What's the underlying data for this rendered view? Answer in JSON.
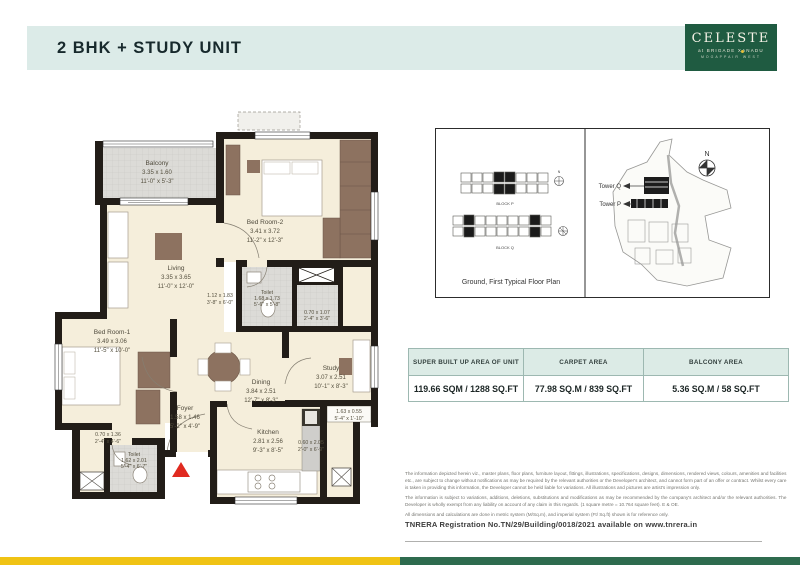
{
  "header": {
    "title": "2 BHK + STUDY UNIT"
  },
  "logo": {
    "name": "CELESTE",
    "subtitle": "at BRIGADE XANADU",
    "location": "MOGAPPAIR WEST"
  },
  "floorplan": {
    "entrance_marker_color": "#e02a20",
    "rooms": {
      "balcony": {
        "name": "Balcony",
        "m": "3.35 x 1.60",
        "i": "11'-0\" x 5'-3\""
      },
      "living": {
        "name": "Living",
        "m": "3.35 x 3.65",
        "i": "11'-0\" x 12'-0\""
      },
      "bed2": {
        "name": "Bed Room-2",
        "m": "3.41 x 3.72",
        "i": "11'-2\" x 12'-3\""
      },
      "passage": {
        "m": "1.12 x 1.83",
        "i": "3'-8\" x 6'-0\""
      },
      "toilet2": {
        "name": "Toilet",
        "m": "1.68 x 1.73",
        "i": "5'-6\" x 5'-8\""
      },
      "shaft": {
        "m": "0.70 x 1.07",
        "i": "2'-4\" x 3'-6\""
      },
      "bed1": {
        "name": "Bed Room-1",
        "m": "3.49 x 3.06",
        "i": "11'-5\" x 10'-0\""
      },
      "niche": {
        "m": "0.70 x 1.36",
        "i": "2'-4\" x 4'-6\""
      },
      "toilet1": {
        "name": "Toilet",
        "m": "1.62 x 2.01",
        "i": "5'-4\" x 6'-7\""
      },
      "foyer": {
        "name": "Foyer",
        "m": "1.58 x 1.46",
        "i": "5'-2\" x 4'-9\""
      },
      "dining": {
        "name": "Dining",
        "m": "3.84 x 2.51",
        "i": "12'-7\" x 8'-3\""
      },
      "study": {
        "name": "Study",
        "m": "3.07 x 2.51",
        "i": "10'-1\" x 8'-3\""
      },
      "kitchen": {
        "name": "Kitchen",
        "m": "2.81 x 2.56",
        "i": "9'-3\" x 8'-5\""
      },
      "utility": {
        "m": "0.60 x 2.05",
        "i": "2'-0\" x 6'-9\""
      },
      "ledge": {
        "m": "1.63 x 0.55",
        "i": "5'-4\" x 1'-10\""
      }
    }
  },
  "keyplan": {
    "caption": "Ground, First Typical Floor Plan",
    "block_p": "BLOCK P",
    "block_q": "BLOCK Q",
    "tower_q": "Tower Q",
    "tower_p": "Tower P",
    "north": "N"
  },
  "area_table": {
    "columns": [
      {
        "header": "SUPER BUILT UP AREA OF UNIT",
        "value": "119.66 SQM / 1288 SQ.FT"
      },
      {
        "header": "CARPET AREA",
        "value": "77.98 SQ.M / 839 SQ.FT"
      },
      {
        "header": "BALCONY AREA",
        "value": "5.36 SQ.M / 58 SQ.FT"
      }
    ]
  },
  "disclaimer": {
    "p1": "The information depicted herein viz., master plans, floor plans, furniture layout, fittings, illustrations, specifications, designs, dimensions, rendered views, colours, amenities and facilities etc., are subject to change without notifications as may be required by the relevant authorities or the Developer's architect, and cannot form part of an offer or contract. Whilst every care is taken in providing this information, the Developer cannot be held liable for variations. All illustrations and pictures are artist's impression only.",
    "p2": "The information is subject to variations, additions, deletions, substitutions and modifications as may be recommended by the company's architect and/or the relevant authorities. The Developer is wholly exempt from any liability on account of any claim in this regards. (1 square metre = 10.764 square feet). E & OE.",
    "p3": "All dimensions and calculations are done in metric system (M/Sq.m), and imperial system (Ft/ Sq.ft) shown is for reference only."
  },
  "rera": {
    "text": "TNRERA Registration No.TN/29/Building/0018/2021 available on www.tnrera.in"
  },
  "colors": {
    "band": "#dcebe8",
    "logo_green": "#1f5b41",
    "bar_yellow": "#f0c314",
    "bar_green": "#2e6b4e",
    "wall": "#221d18",
    "floor": "#f5eedb",
    "furniture": "#8d7260",
    "accent_dot": "#e5bf39"
  }
}
